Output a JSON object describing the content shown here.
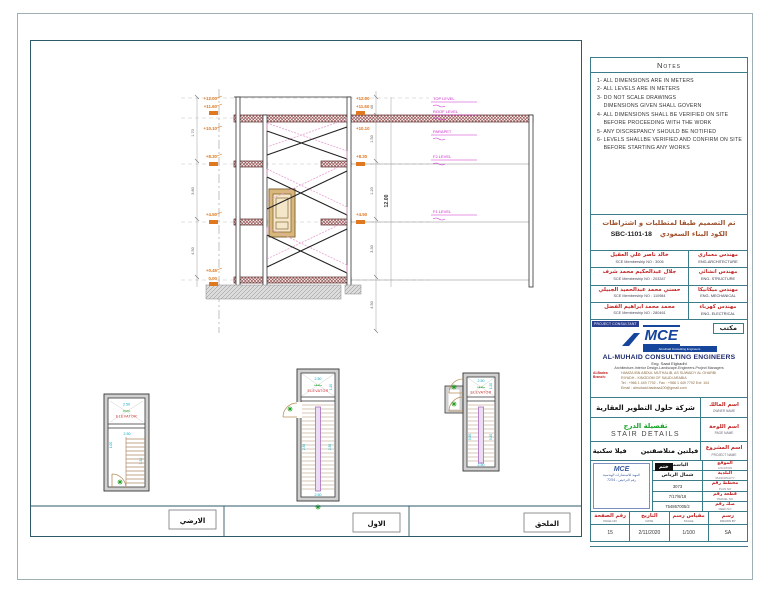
{
  "notes": {
    "title": "Notes",
    "items": [
      "1- ALL DIMENSIONS ARE IN METERS",
      "2- ALL LEVELS ARE IN METERS",
      "3- DO NOT SCALE DRAWINGS",
      "    DIMENSIONS GIVEN SHALL GOVERN",
      "4- ALL DIMENSIONS SHALL BE VERIFIED ON SITE",
      "    BEFORE PROCEEDING WITH THE WORK",
      "5- ANY DISCREPANCY SHOULD BE NOTIFIED",
      "6- LEVELS SHALLBE VERIFIED AND CONFIRM ON SITE",
      "    BEFORE STARTING ANY WORKS"
    ]
  },
  "design_code": {
    "line1": "تم التصميم طبقا لمتطلبات  و اشتراطات",
    "line2": "الكود البناء السعودي",
    "code": "SBC-1101-18"
  },
  "engineers": [
    {
      "name": "خالد ناصر علي العقيل",
      "membership": "SCE Membership NO : 3006",
      "role_ar": "مهندس معماري",
      "role_en": "ENG-ARCHITECTURE"
    },
    {
      "name": "جلال عبدالحكيم محمد شرف",
      "membership": "SCE Membership NO : 203347",
      "role_ar": "مهندس انشائي",
      "role_en": "ENG- STRUCTURE"
    },
    {
      "name": "حسني محمد عبدالحميد الجبيلي",
      "membership": "SCE Membership NO : 110984",
      "role_ar": "مهندس ميكانيكا",
      "role_en": "ENG- MECHANICAL"
    },
    {
      "name": "محمد محمد ابراهيم الفضل",
      "membership": "SCE Membership NO : 280461",
      "role_ar": "مهندس كهرباء",
      "role_en": "ENG- ELECTRICAL"
    }
  ],
  "consultant": {
    "chip": "PROJECT CONSULTANT",
    "office_ar": "مكتب",
    "logo_text": "MCE",
    "logo_sub": "Almuhaid Consulting Engineers",
    "company": "AL-MUHAID CONSULTING ENGINEERS",
    "engineer": "Eng. Saad Elghadhi",
    "tagline": "Architecture-Interior Design-Landscape-Engineers-Project Managers",
    "branch_label": "Al-Badea Branch:",
    "address1": "HAMZA IBN ABDUL MUTHALIB, AS SUWAIDY AL GHARBI",
    "address2": "RIYADH - KINGDOM OF SAUDI ARABIA",
    "phone": "Tel : +966 1 449 7792 - Fax : +966 1 449 7792 Ext: 104",
    "email": "Email :  almuhaid.badeaa100@gmail.com"
  },
  "title_block": {
    "owner": {
      "value": "شركة حلول التطوير العقارية",
      "label_ar": "اسم المالك",
      "label_en": "OWNER NAME"
    },
    "page": {
      "value_ar": "تفصيلة الدرج",
      "value_en": "STAIR DETAILS",
      "label_ar": "اسم اللوحة",
      "label_en": "PAGE NAME"
    },
    "project": {
      "value_a": "فيلا سكنية",
      "value_b": "فيلتين متلاصقتين",
      "label_ar": "اسم المشروع",
      "label_en": "PROJECT NAME"
    },
    "stamp": {
      "mce": "MCE",
      "line1": "المهيد للاستشارات الهندسية",
      "line2": "رقم الترخيص - 7254",
      "seal": "ختم"
    },
    "details": [
      {
        "value": "الياسمين",
        "label_ar": "الموقع",
        "label_en": "LOCATION"
      },
      {
        "value": "شمال الرياض",
        "label_ar": "البلدية",
        "label_en": "MUNICIPALITY"
      },
      {
        "value": "3073",
        "label_ar": "مخطط رقم",
        "label_en": "PLAN NO"
      },
      {
        "value": "7/17/8/18",
        "label_ar": "قطعة رقم",
        "label_en": "PARCEL NO"
      },
      {
        "value": "754867005/2",
        "label_ar": "صك رقم",
        "label_en": "DEED NO"
      }
    ],
    "footer": [
      {
        "label_ar": "رقم الصفحة",
        "label_en": "PAGE NO",
        "value": "15"
      },
      {
        "label_ar": "التاريخ",
        "label_en": "DATE",
        "value": "2/11/2020"
      },
      {
        "label_ar": "مقياس رسم",
        "label_en": "SCALE",
        "value": "1/100"
      },
      {
        "label_ar": "رسم",
        "label_en": "DRAWN BY",
        "value": "SA"
      }
    ]
  },
  "section": {
    "levels_left": [
      "+12.00",
      "+11.60",
      "+10.10",
      "+8.30",
      "+4.50",
      "+0.45",
      "0.00"
    ],
    "levels_right": [
      "+12.00",
      "+11.60",
      "+10.10",
      "+8.30",
      "+4.50"
    ],
    "level_tags": [
      "TOP LEVEL",
      "ROOF LEVEL",
      "PARAPET",
      "F2 LEVEL",
      "F1 LEVEL"
    ],
    "overall_dim": "12.00",
    "dims_right": [
      "40",
      "1.50",
      "1.20",
      "3.30",
      "4.50"
    ],
    "dims_left": [
      "1.70",
      "3.80",
      "4.50"
    ]
  },
  "plans": {
    "ground": {
      "label": "الارضي",
      "elevator_en": "ELEVATOR",
      "elevator_ar": "مصعد",
      "dim_top": "2.50",
      "dim_mid": "2.50",
      "dim_right": "3.30",
      "dim_left": "1.00"
    },
    "first": {
      "label": "الاول",
      "elevator_en": "ELEVATOR",
      "elevator_ar": "مصعد",
      "dim_top": "2.50",
      "dim_right": "1.20",
      "dim_side_left": "2.30",
      "dim_side_right": "2.30",
      "dim_bottom": "2.50"
    },
    "annex": {
      "label": "الملحق",
      "elevator_en": "ELEVATOR",
      "elevator_ar": "مصعد",
      "dim_top": "2.50",
      "dim_right": "1.20",
      "dim_side_left": "5.20",
      "dim_side_right": "5.20",
      "dim_bottom": "2.50"
    }
  }
}
